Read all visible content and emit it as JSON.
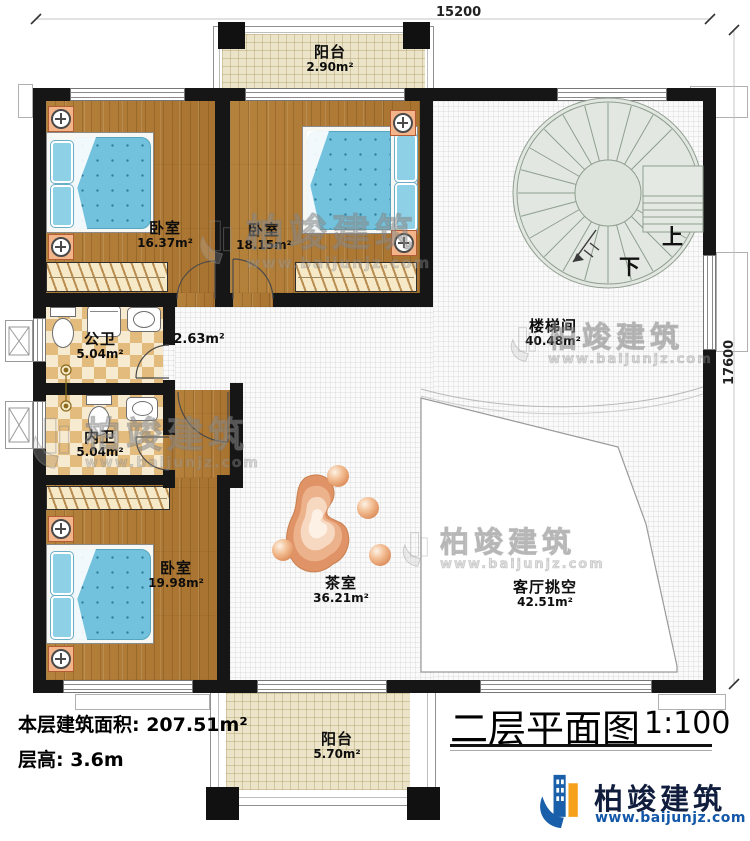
{
  "title": {
    "text": "二层平面图",
    "scale": "1:100"
  },
  "dimensions": {
    "top": "15200",
    "right": "17600"
  },
  "stairs": {
    "up": "上",
    "down": "下"
  },
  "stats": {
    "floor_area": "本层建筑面积: 207.51m²",
    "floor_height": "层高: 3.6m"
  },
  "rooms": [
    {
      "id": "balcony-top",
      "name": "阳台",
      "area": "2.90m²"
    },
    {
      "id": "bedroom-1",
      "name": "卧室",
      "area": "16.37m²"
    },
    {
      "id": "bedroom-2",
      "name": "卧室",
      "area": "18.15m²"
    },
    {
      "id": "stairwell",
      "name": "楼梯间",
      "area": "40.48m²"
    },
    {
      "id": "public-bath",
      "name": "公卫",
      "area": "5.04m²"
    },
    {
      "id": "hallway",
      "name": "",
      "area": "2.63m²"
    },
    {
      "id": "private-bath",
      "name": "内卫",
      "area": "5.04m²"
    },
    {
      "id": "bedroom-3",
      "name": "卧室",
      "area": "19.98m²"
    },
    {
      "id": "tea-room",
      "name": "茶室",
      "area": "36.21m²"
    },
    {
      "id": "living-void",
      "name": "客厅挑空",
      "area": "42.51m²"
    },
    {
      "id": "balcony-bottom",
      "name": "阳台",
      "area": "5.70m²"
    }
  ],
  "brand": {
    "company": "柏竣建筑",
    "website": "www.baijunjz.com"
  },
  "colors": {
    "wall": "#161616",
    "wood": "#ad7834",
    "bed_blue": "#72c2de",
    "tile": "#e3bb7d",
    "logo_blue": "#1a5faa",
    "logo_orange": "#f5a11c"
  }
}
